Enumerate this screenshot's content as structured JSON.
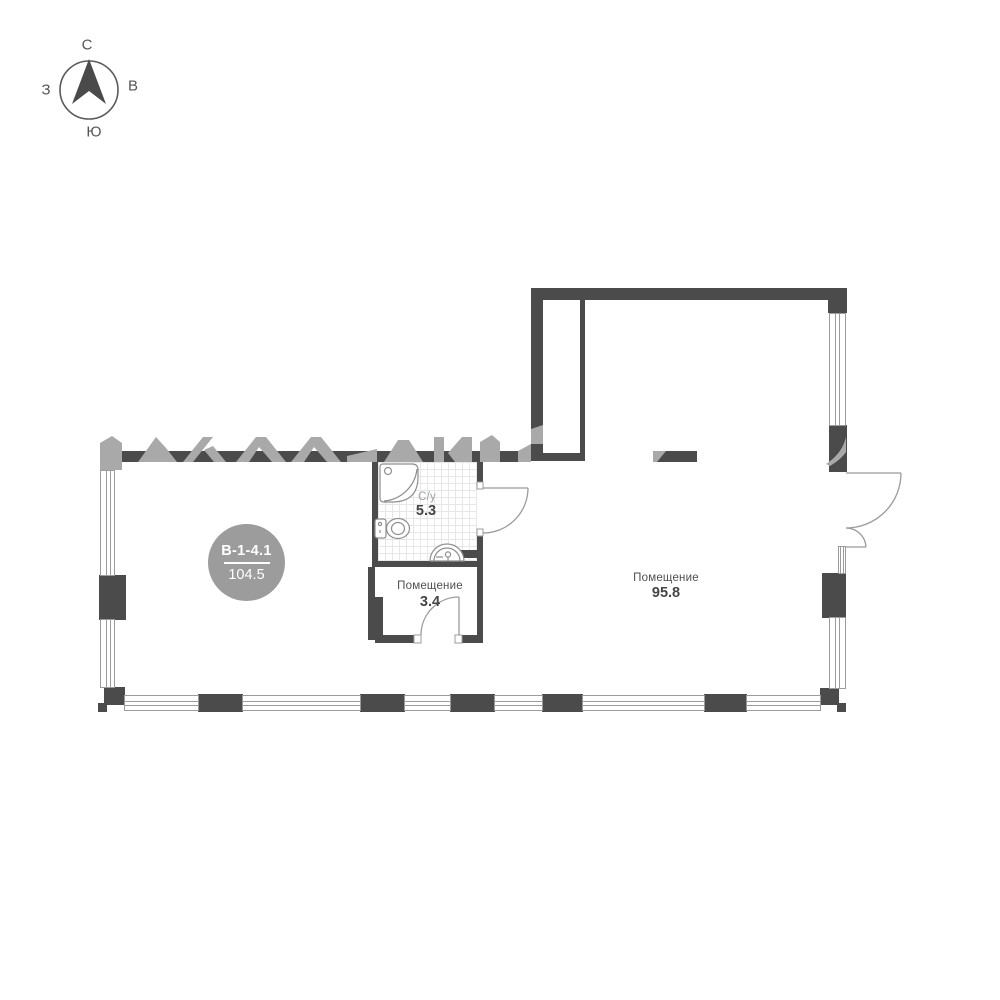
{
  "compass": {
    "north": "С",
    "east": "В",
    "west": "З",
    "south": "Ю"
  },
  "unit_badge": {
    "code": "В-1-4.1",
    "total_area": "104.5"
  },
  "rooms": {
    "bathroom": {
      "name": "С/у",
      "area": "5.3"
    },
    "storage": {
      "name": "Помещение",
      "area": "3.4"
    },
    "main": {
      "name": "Помещение",
      "area": "95.8"
    }
  },
  "colors": {
    "wall": "#4b4b4b",
    "thin_line": "#9b9b9b",
    "badge": "#9c9c9c",
    "watermark": "#a9a9a9",
    "tile_grid": "#e7e7e7",
    "label": "#4f4f4f"
  }
}
